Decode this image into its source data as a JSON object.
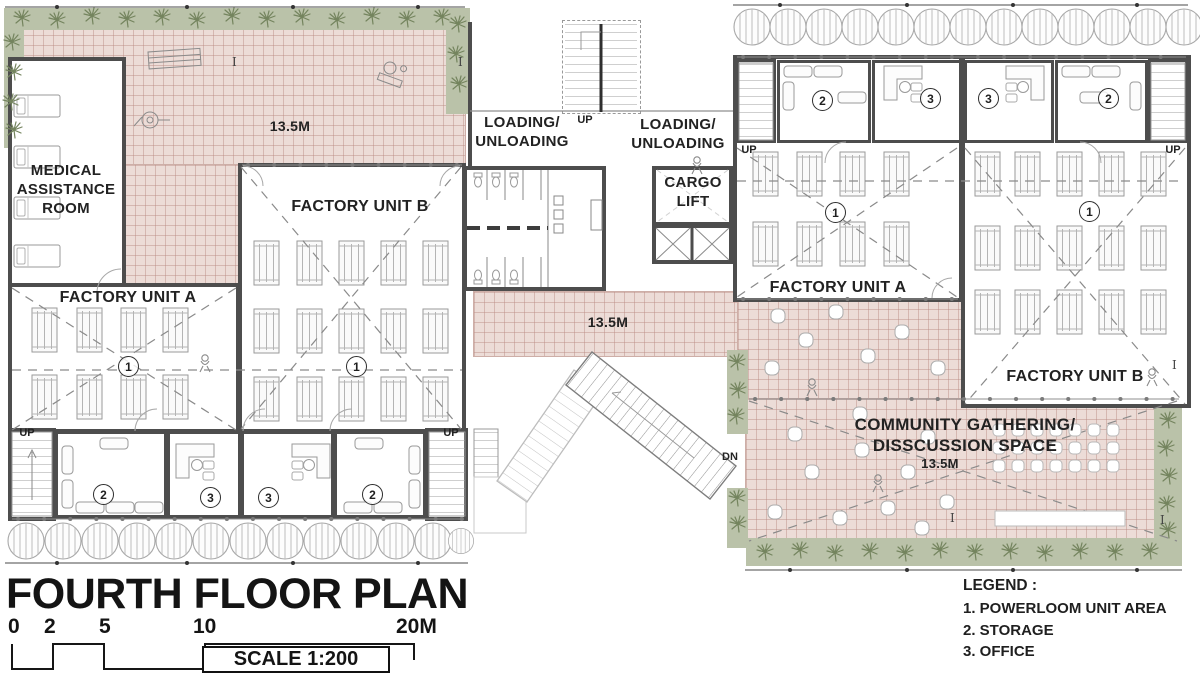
{
  "plan": {
    "rooms": {
      "medical": "MEDICAL ASSISTANCE ROOM",
      "factory_unit_a": "FACTORY UNIT A",
      "factory_unit_b": "FACTORY UNIT B",
      "loading_unloading": "LOADING/\nUNLOADING",
      "cargo_lift": "CARGO\nLIFT",
      "community": "COMMUNITY GATHERING/\nDISSCUSSION SPACE"
    },
    "annotations": {
      "up": "UP",
      "down": "DN",
      "dimension": "13.5M",
      "column": "I",
      "num_powerloom": "1",
      "num_storage": "2",
      "num_office": "3"
    }
  },
  "title_block": {
    "title": "FOURTH FLOOR PLAN",
    "scale_marks": [
      "0",
      "2",
      "5",
      "10",
      "20M"
    ],
    "scale_label": "SCALE 1:200"
  },
  "legend": {
    "heading": "LEGEND :",
    "items": [
      "1. POWERLOOM UNIT AREA",
      "2. STORAGE",
      "3. OFFICE"
    ]
  },
  "colors": {
    "tile": "#ecdcd7",
    "tile_line": "#c9a8a0",
    "green": "#bac2a9",
    "plant": "#74845e",
    "wall": "#4d4d4d",
    "text": "#1f1f1f"
  }
}
